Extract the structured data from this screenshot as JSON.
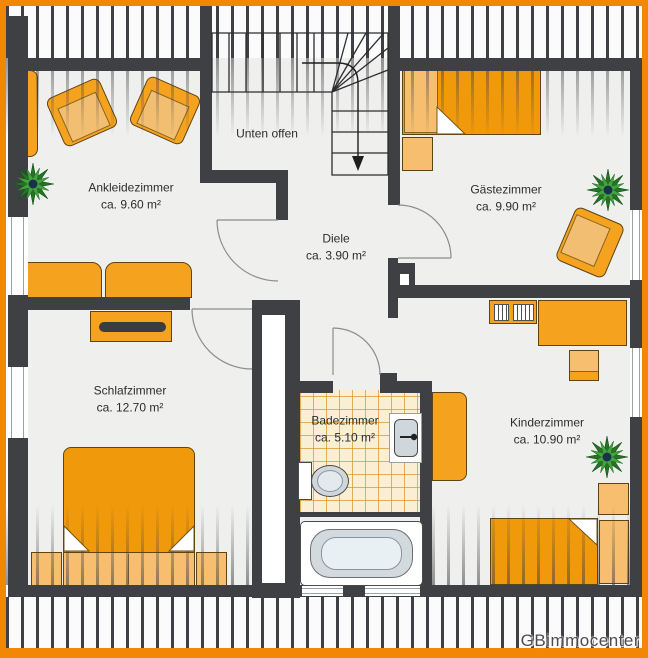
{
  "plan_title": "floor-plan",
  "stairwell": {
    "label": "Unten offen"
  },
  "watermark": {
    "text": "GBimmocenter"
  },
  "rooms": [
    {
      "id": "ankleidezimmer",
      "name": "Ankleidezimmer",
      "area": "ca. 9.60 m²"
    },
    {
      "id": "gaestezimmer",
      "name": "Gästezimmer",
      "area": "ca. 9.90 m²"
    },
    {
      "id": "diele",
      "name": "Diele",
      "area": "ca. 3.90 m²"
    },
    {
      "id": "schlafzimmer",
      "name": "Schlafzimmer",
      "area": "ca. 12.70 m²"
    },
    {
      "id": "badezimmer",
      "name": "Badezimmer",
      "area": "ca. 5.10 m²"
    },
    {
      "id": "kinderzimmer",
      "name": "Kinderzimmer",
      "area": "ca. 10.90 m²"
    }
  ],
  "colors": {
    "frame": "#F28705",
    "wall": "#3E4043",
    "furniture": "#F5A21F",
    "furniture_light": "#F6BE6E",
    "duvet": "#F0990A",
    "tile_bg": "#FAEFD3",
    "tile_line": "#DFA64E",
    "floor": "#EFEFEE"
  }
}
